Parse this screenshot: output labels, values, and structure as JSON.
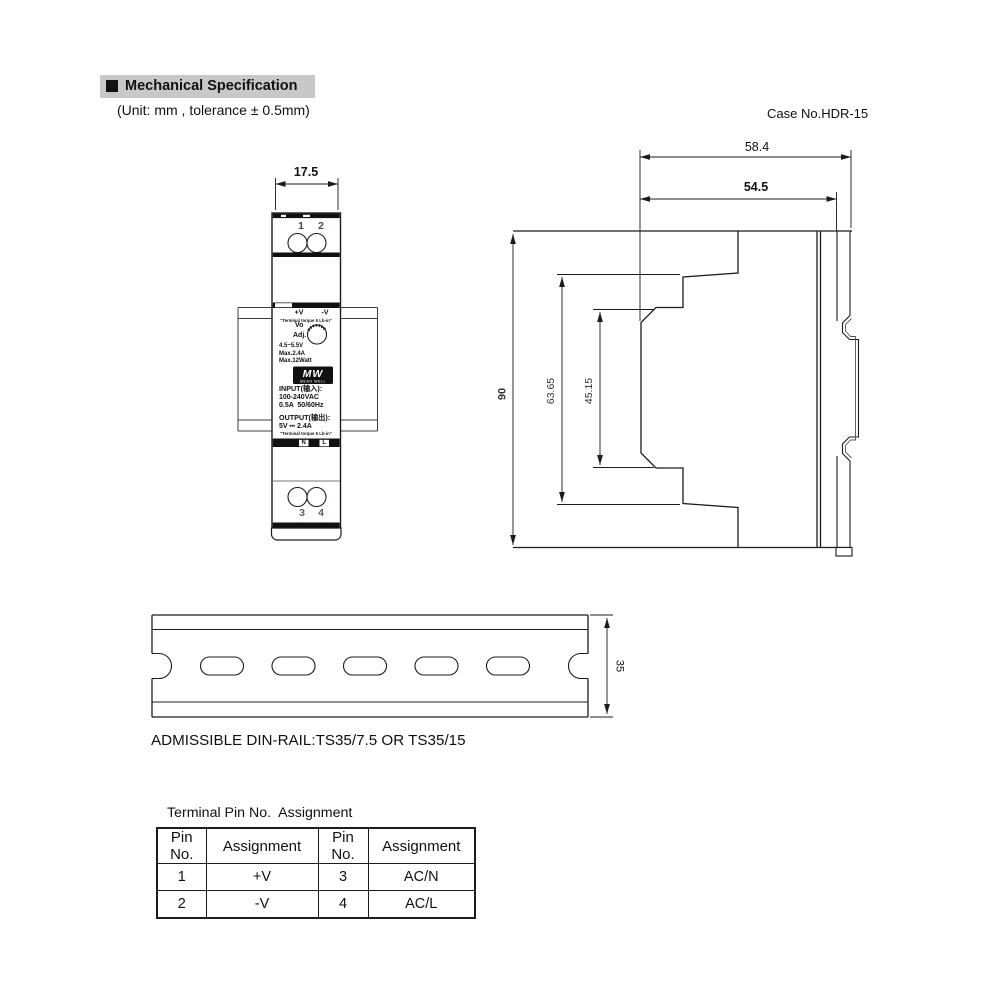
{
  "header": {
    "title": "Mechanical Specification",
    "unit_note": "(Unit: mm , tolerance ± 0.5mm)",
    "case_no": "Case No.HDR-15"
  },
  "front_view": {
    "dim_width": "17.5",
    "pins": {
      "p1": "1",
      "p2": "2",
      "p3": "3",
      "p4": "4"
    },
    "label": {
      "pos": "+V",
      "neg": "-V",
      "torque_top": "\"Terminal torque 5 Lb-in\"",
      "vo": "Vo",
      "adj": "Adj.",
      "range": "4.5~5.5V",
      "max_a": "Max.2.4A",
      "max_w": "Max.12Watt",
      "logo": "MW",
      "logo_sub": "MEAN WELL",
      "input_title": "INPUT(输入):",
      "input_v": "100-240VAC",
      "input_a": "0.5A  50/60Hz",
      "output_title": "OUTPUT(输出):",
      "output_v": "5V ⎓ 2.4A",
      "torque_bottom": "\"Terminal torque 5 Lb-in\"",
      "n": "N",
      "l": "L"
    }
  },
  "side_view": {
    "dim_total_depth": "58.4",
    "dim_case_depth": "54.5",
    "dim_height": "90",
    "dim_upper": "63.65",
    "dim_inner": "45.15"
  },
  "din_rail": {
    "dim_height": "35",
    "note": "ADMISSIBLE DIN-RAIL:TS35/7.5 OR TS35/15"
  },
  "pin_table": {
    "title": "Terminal Pin No.  Assignment",
    "headers": [
      "Pin No.",
      "Assignment",
      "Pin No.",
      "Assignment"
    ],
    "rows": [
      [
        "1",
        "+V",
        "3",
        "AC/N"
      ],
      [
        "2",
        "-V",
        "4",
        "AC/L"
      ]
    ]
  }
}
